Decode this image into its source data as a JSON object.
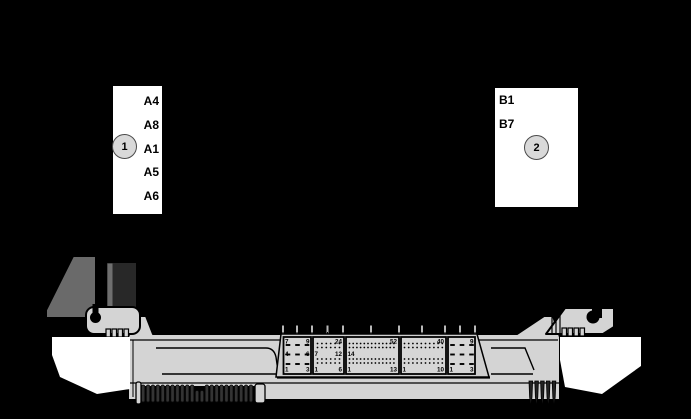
{
  "colors": {
    "background": "#000000",
    "body_gray": "#d4d4d4",
    "panel_gray": "#cfcfcf",
    "harness_dark": "#282828",
    "harness_gray": "#6a6a6a",
    "callout_white": "#ffffff",
    "circle_fill": "#d9d9d9",
    "pin_color": "#000000"
  },
  "callout_box_1": {
    "circle_number": "1",
    "pin_labels": [
      "A4",
      "A8",
      "A1",
      "A5",
      "A6"
    ]
  },
  "callout_box_2": {
    "circle_number": "2",
    "pin_labels": [
      "B1",
      "B7"
    ]
  },
  "ecu_connectors": {
    "block_9pin_left": {
      "pin_count": 9,
      "labels": {
        "top_left": "7",
        "top_right": "9",
        "mid_left": "4",
        "mid_right": "6",
        "bottom_left": "1",
        "bottom_right": "3"
      }
    },
    "block_24pin": {
      "pin_count": 24,
      "labels": {
        "top_right": "24",
        "mid_left": "7",
        "mid_right": "12",
        "bottom_left": "1",
        "bottom_right": "6"
      }
    },
    "block_52pin": {
      "pin_count": 52,
      "labels": {
        "top_right": "52",
        "mid_left": "14",
        "bottom_left": "1",
        "bottom_right": "13"
      }
    },
    "block_40pin": {
      "pin_count": 40,
      "labels": {
        "top_right": "40",
        "bottom_left": "1",
        "bottom_right": "10"
      }
    },
    "block_9pin_right": {
      "pin_count": 9,
      "labels": {
        "top_right": "9",
        "bottom_left": "1",
        "bottom_right": "3"
      }
    }
  }
}
